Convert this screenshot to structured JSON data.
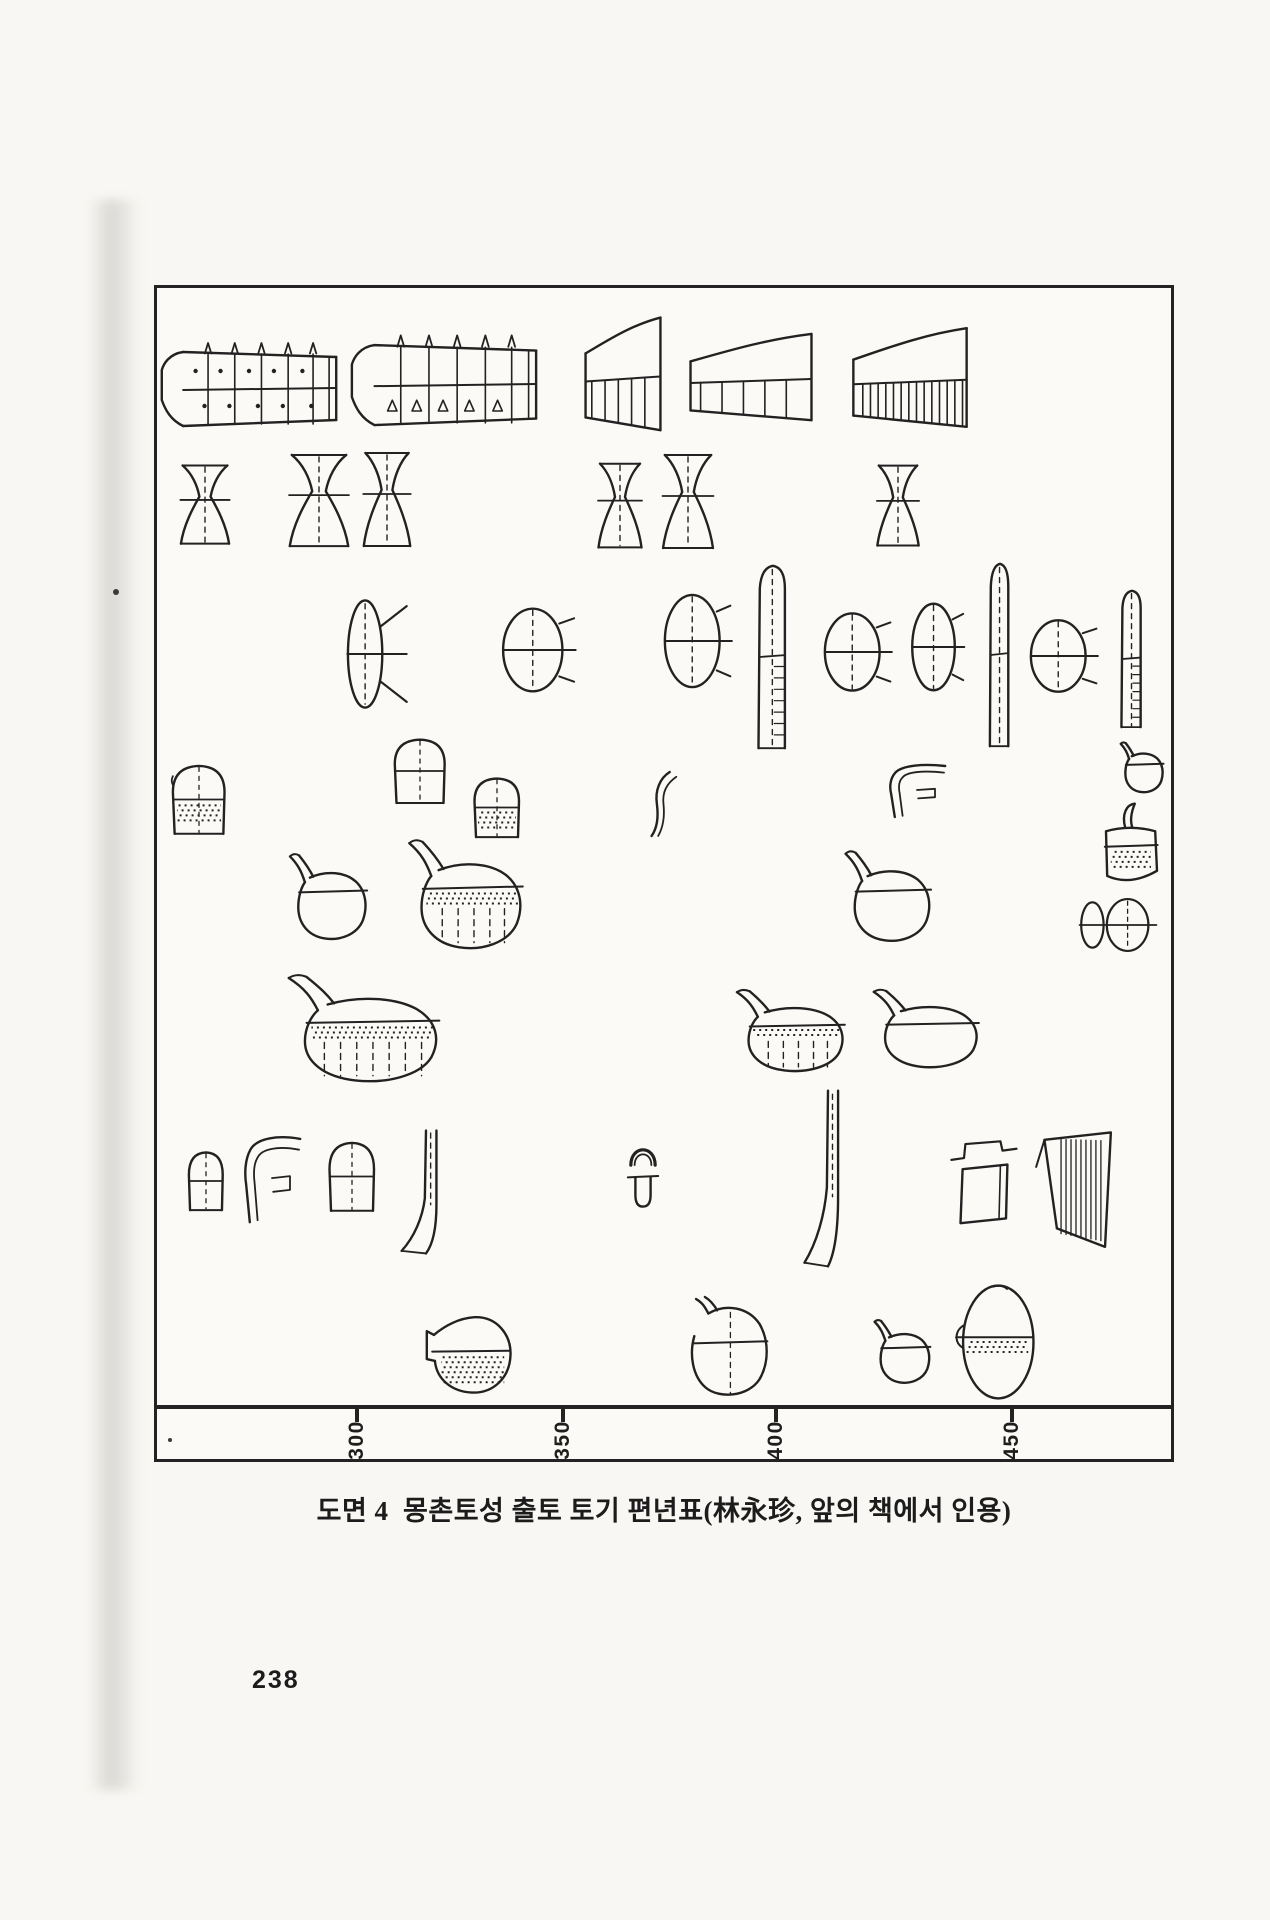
{
  "page": {
    "background": "#f8f7f3",
    "ink": "#222222",
    "page_number": "238",
    "specks": [
      {
        "x": 113,
        "y": 589,
        "r": 3
      },
      {
        "x": 168,
        "y": 1438,
        "r": 2
      }
    ]
  },
  "figure": {
    "caption": "도면 4  몽촌토성 출토 토기 편년표(林永珍, 앞의 책에서 인용)"
  },
  "chart_data": {
    "type": "timeline",
    "title": "몽촌토성 출토 토기 편년표",
    "source": "林永珍, 앞의 책에서 인용",
    "frame": {
      "left": 154,
      "top": 285,
      "width": 1020,
      "height": 1177
    },
    "x_axis": {
      "tick_labels": [
        "300",
        "350",
        "400",
        "450"
      ],
      "tick_positions": [
        200,
        406,
        619,
        855
      ],
      "axis_band": {
        "top": 1117
      }
    },
    "artifacts": [
      {
        "shape": "stand_wide",
        "variant": "dots",
        "x": 3,
        "y": 50,
        "w": 178,
        "h": 100
      },
      {
        "shape": "stand_wide",
        "variant": "tri",
        "x": 193,
        "y": 42,
        "w": 188,
        "h": 108
      },
      {
        "shape": "stand_taper",
        "variant": "up",
        "x": 427,
        "y": 27,
        "w": 78,
        "h": 128
      },
      {
        "shape": "stand_taper",
        "variant": "plain",
        "x": 531,
        "y": 44,
        "w": 126,
        "h": 98
      },
      {
        "shape": "stand_taper",
        "variant": "hatch",
        "x": 694,
        "y": 38,
        "w": 118,
        "h": 112
      },
      {
        "shape": "hourglass",
        "x": 20,
        "y": 175,
        "w": 56,
        "h": 84
      },
      {
        "shape": "hourglass",
        "x": 128,
        "y": 164,
        "w": 68,
        "h": 98
      },
      {
        "shape": "hourglass",
        "x": 203,
        "y": 162,
        "w": 54,
        "h": 100
      },
      {
        "shape": "hourglass",
        "x": 438,
        "y": 173,
        "w": 50,
        "h": 90
      },
      {
        "shape": "hourglass",
        "x": 502,
        "y": 164,
        "w": 58,
        "h": 100
      },
      {
        "shape": "hourglass",
        "x": 717,
        "y": 175,
        "w": 48,
        "h": 86
      },
      {
        "shape": "finned_dish",
        "x": 187,
        "y": 309,
        "w": 66,
        "h": 114
      },
      {
        "shape": "lidded_bowl",
        "x": 343,
        "y": 318,
        "w": 78,
        "h": 88
      },
      {
        "shape": "lidded_bowl",
        "x": 505,
        "y": 304,
        "w": 72,
        "h": 98
      },
      {
        "shape": "tall_stem",
        "variant": "hatch",
        "x": 583,
        "y": 274,
        "w": 66,
        "h": 190
      },
      {
        "shape": "lidded_bowl",
        "x": 665,
        "y": 323,
        "w": 72,
        "h": 82
      },
      {
        "shape": "lidded_bowl",
        "x": 753,
        "y": 313,
        "w": 56,
        "h": 92
      },
      {
        "shape": "tall_stem",
        "variant": "plain",
        "x": 820,
        "y": 272,
        "w": 46,
        "h": 190
      },
      {
        "shape": "lidded_bowl",
        "x": 871,
        "y": 330,
        "w": 72,
        "h": 76
      },
      {
        "shape": "tall_stem",
        "variant": "hatch",
        "x": 951,
        "y": 300,
        "w": 48,
        "h": 142
      },
      {
        "shape": "cup",
        "variant": "deep",
        "x": 13,
        "y": 475,
        "w": 58,
        "h": 73
      },
      {
        "shape": "cup",
        "variant": "plain",
        "x": 235,
        "y": 449,
        "w": 56,
        "h": 68
      },
      {
        "shape": "cup",
        "variant": "stipple",
        "x": 315,
        "y": 488,
        "w": 50,
        "h": 63
      },
      {
        "shape": "sherd",
        "x": 488,
        "y": 482,
        "w": 33,
        "h": 68
      },
      {
        "shape": "rim_sherd",
        "x": 730,
        "y": 475,
        "w": 60,
        "h": 60
      },
      {
        "shape": "small_jar",
        "x": 961,
        "y": 452,
        "w": 46,
        "h": 54
      },
      {
        "shape": "jar",
        "variant": "plain",
        "x": 128,
        "y": 562,
        "w": 83,
        "h": 92
      },
      {
        "shape": "jar",
        "variant": "stipple",
        "x": 245,
        "y": 547,
        "w": 122,
        "h": 117
      },
      {
        "shape": "jar",
        "variant": "plain",
        "x": 683,
        "y": 559,
        "w": 92,
        "h": 97
      },
      {
        "shape": "horn_jar",
        "x": 943,
        "y": 514,
        "w": 60,
        "h": 86
      },
      {
        "shape": "tiny_pair",
        "x": 921,
        "y": 610,
        "w": 80,
        "h": 54
      },
      {
        "shape": "jar",
        "variant": "bigstipple",
        "x": 122,
        "y": 682,
        "w": 162,
        "h": 115
      },
      {
        "shape": "jar",
        "variant": "stipple",
        "x": 573,
        "y": 698,
        "w": 116,
        "h": 88
      },
      {
        "shape": "jar",
        "variant": "open",
        "x": 710,
        "y": 698,
        "w": 113,
        "h": 84
      },
      {
        "shape": "cup",
        "variant": "plain",
        "x": 30,
        "y": 862,
        "w": 38,
        "h": 62
      },
      {
        "shape": "rim_sherd",
        "x": 85,
        "y": 846,
        "w": 60,
        "h": 98
      },
      {
        "shape": "cup",
        "variant": "plain",
        "x": 170,
        "y": 852,
        "w": 50,
        "h": 73
      },
      {
        "shape": "neck_ped",
        "x": 240,
        "y": 840,
        "w": 58,
        "h": 128
      },
      {
        "shape": "handle",
        "x": 467,
        "y": 854,
        "w": 38,
        "h": 68
      },
      {
        "shape": "neck_ped",
        "x": 643,
        "y": 799,
        "w": 56,
        "h": 183
      },
      {
        "shape": "box_lid",
        "x": 793,
        "y": 844,
        "w": 70,
        "h": 93
      },
      {
        "shape": "funnel",
        "x": 875,
        "y": 842,
        "w": 83,
        "h": 123
      },
      {
        "shape": "bottle",
        "variant": "stipple",
        "x": 268,
        "y": 1019,
        "w": 90,
        "h": 93
      },
      {
        "shape": "round_jar",
        "x": 525,
        "y": 1009,
        "w": 88,
        "h": 103
      },
      {
        "shape": "small_jar",
        "x": 714,
        "y": 1029,
        "w": 60,
        "h": 68
      },
      {
        "shape": "ovoid_jar",
        "x": 792,
        "y": 994,
        "w": 88,
        "h": 120
      }
    ]
  }
}
